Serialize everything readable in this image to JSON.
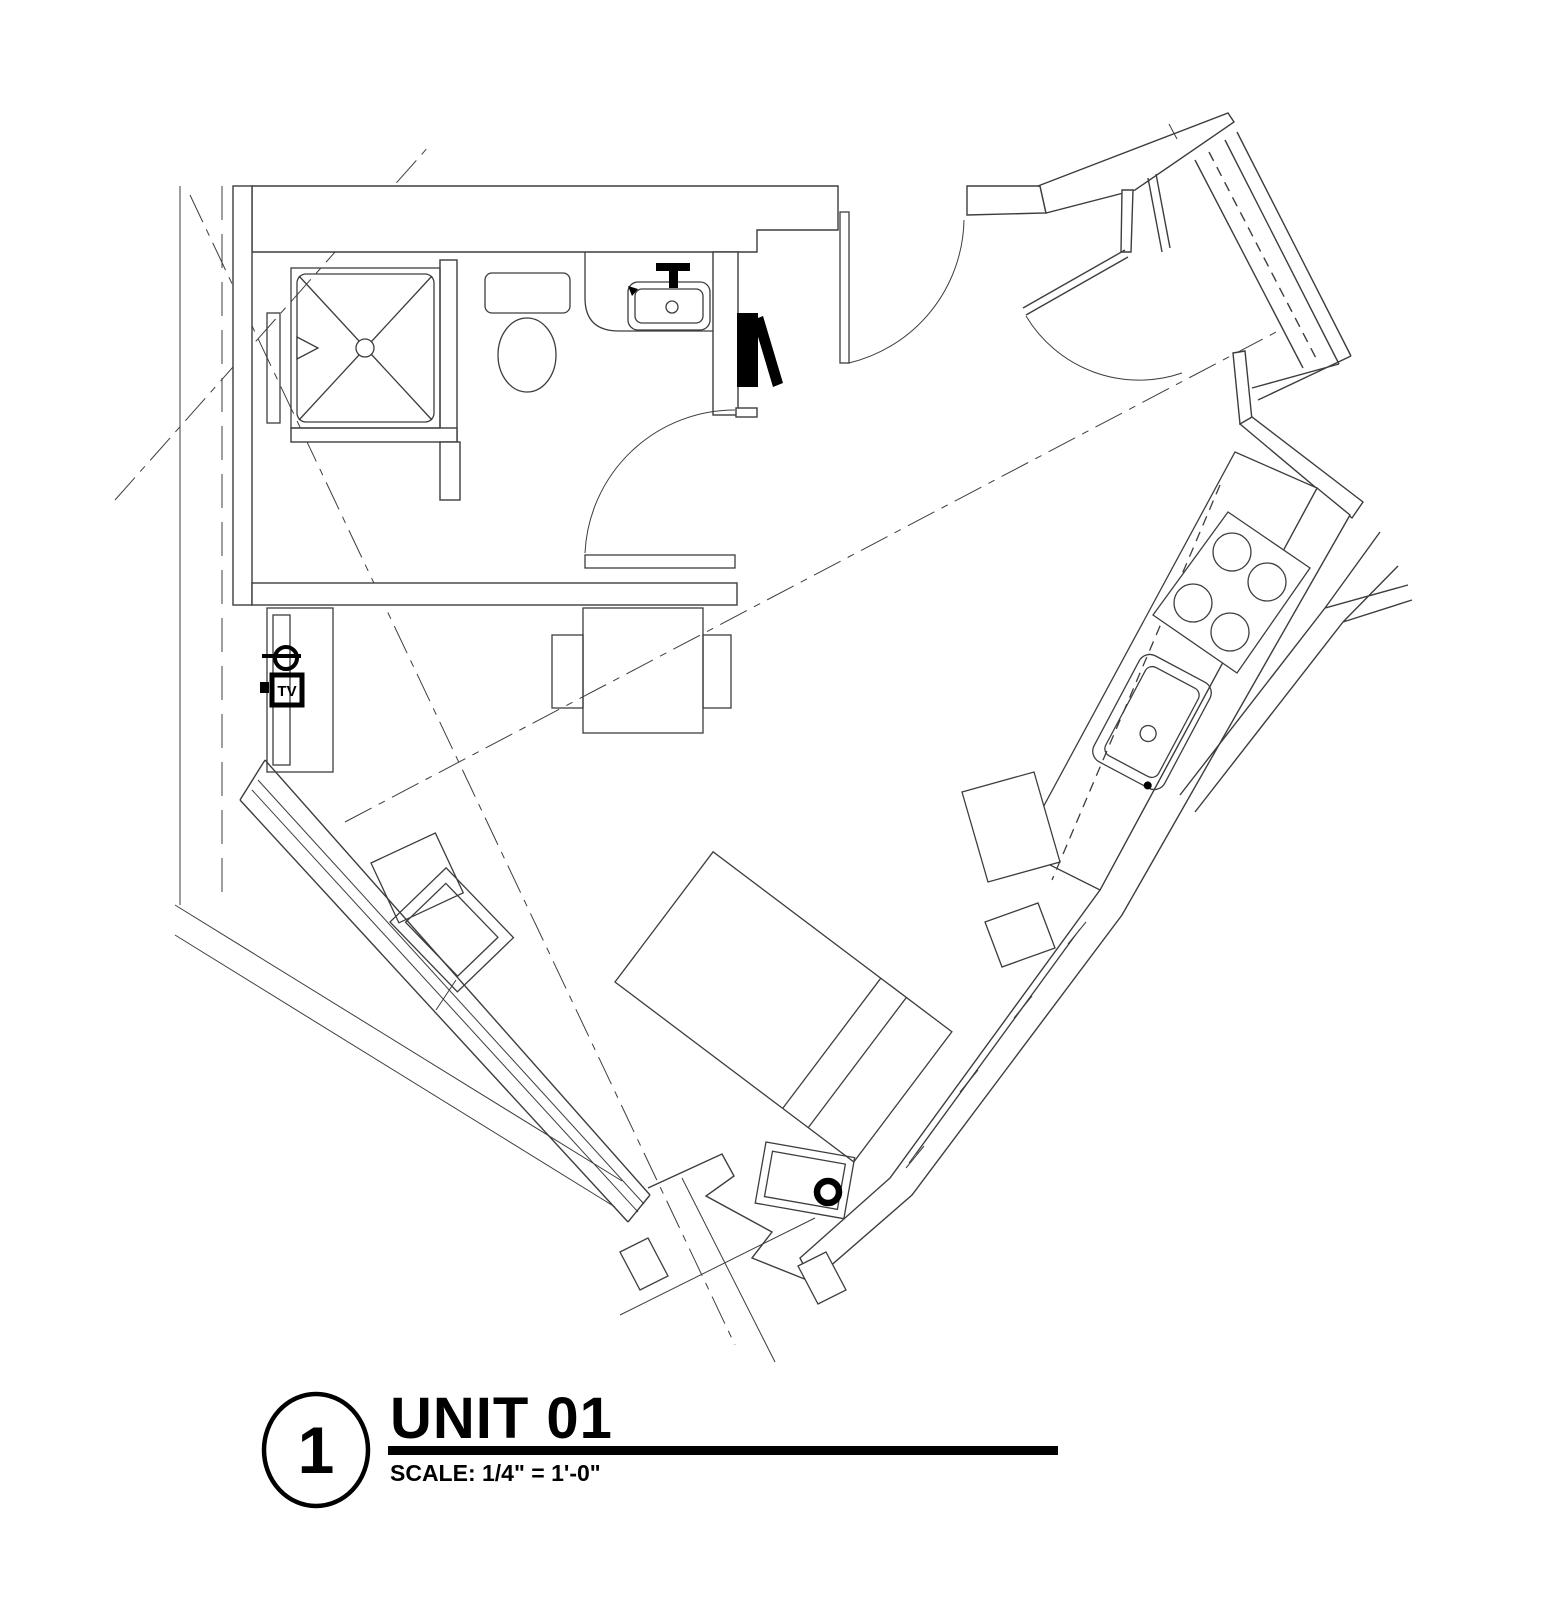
{
  "theme": {
    "paper": "#ffffff",
    "ink": "#3d3d3d",
    "ink_bold": "#000000"
  },
  "title_block": {
    "detail_number": "1",
    "title": "UNIT 01",
    "scale": "SCALE: 1/4\" = 1'-0\""
  },
  "plan": {
    "unit_name": "UNIT 01",
    "labels": {
      "tv": "TV"
    },
    "fixtures": [
      "shower-pan-with-drain",
      "shower-head",
      "toilet",
      "vanity-sink",
      "faucet",
      "bathroom-swing-door",
      "corridor-entry-door",
      "closet-with-shelf-dashed",
      "closet-swing-door",
      "black-pocket-door",
      "kitchen-counter",
      "range-4-burners",
      "kitchen-sink",
      "base-cabinets",
      "upper-cabinet-dashed-line",
      "dining-table",
      "dining-chair",
      "dining-chair",
      "tv-credenza",
      "wall-mounted-tv",
      "duplex-outlet-symbol",
      "floor-outlet-symbol",
      "bed",
      "nightstand",
      "lounge-chair",
      "ottoman",
      "window-southwest",
      "window-southeast",
      "property-line",
      "centerline-dashed",
      "diagonal-grid-lines",
      "vestibule-x-brace"
    ]
  }
}
